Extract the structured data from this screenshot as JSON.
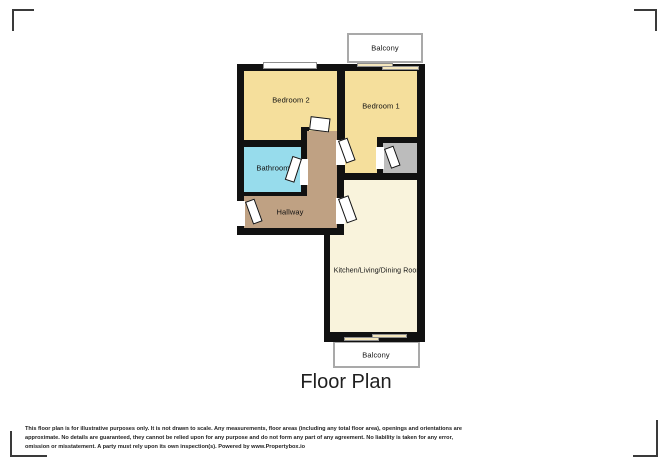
{
  "document": {
    "title": "Floor Plan"
  },
  "rooms": {
    "bedroom2": {
      "label": "Bedroom 2",
      "color": "#f5df9c"
    },
    "bedroom1": {
      "label": "Bedroom 1",
      "color": "#f5df9c"
    },
    "bathroom": {
      "label": "Bathroom",
      "color": "#97dcec"
    },
    "hallway": {
      "label": "Hallway",
      "color": "#bfa183"
    },
    "kitchen": {
      "label": "Kitchen/Living/Dining Room",
      "color": "#f9f3dc"
    },
    "storage": {
      "color": "#bcbcbc"
    },
    "balcony_top": {
      "label": "Balcony"
    },
    "balcony_bottom": {
      "label": "Balcony"
    }
  },
  "colors": {
    "wall": "#111111",
    "door_leaf": "#ffffff",
    "balcony_border": "#a9a9a9",
    "background": "#ffffff"
  },
  "disclaimer": {
    "line1": "This floor plan is for illustrative purposes only. It is not drawn to scale. Any measurements, floor areas (including any total floor area), openings and orientations are",
    "line2": "approximate. No details are guaranteed, they cannot be relied upon for any purpose and do not form any part of any agreement. No liability is taken for any error,",
    "line3": "omission or misstatement. A party must rely upon its own inspection(s). Powered by www.Propertybox.io"
  }
}
